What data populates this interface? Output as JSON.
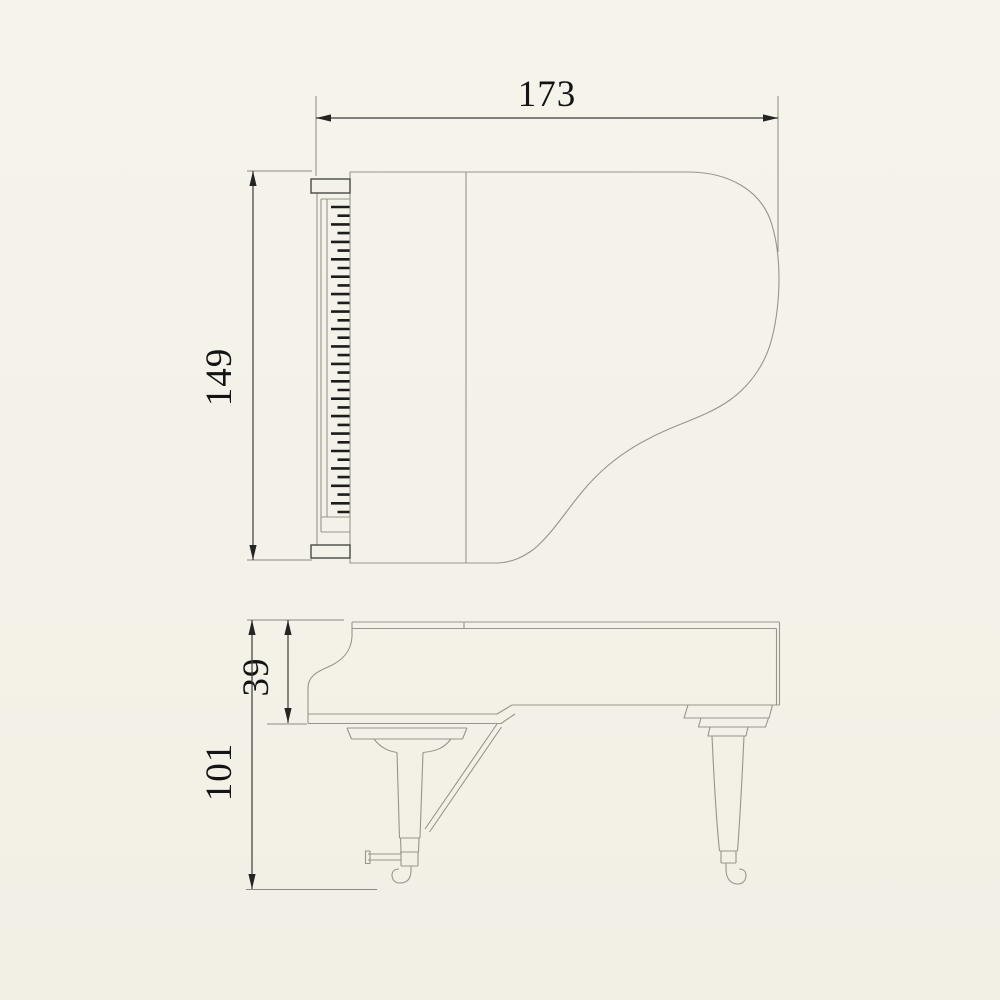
{
  "diagram": {
    "type": "technical-dimension-drawing",
    "subject": "grand piano two-view outline drawing",
    "views": {
      "top_view": {
        "name": "plan view (top)"
      },
      "side_view": {
        "name": "side elevation view"
      }
    },
    "dimensions": {
      "width": {
        "value": "173",
        "location": "top, horizontal, above plan view"
      },
      "depth": {
        "value": "149",
        "location": "left of plan view, rotated 90deg"
      },
      "keyboard_height": {
        "value": "39",
        "location": "left of side view, rotated 90deg"
      },
      "overall_height": {
        "value": "101",
        "location": "left of side view, rotated 90deg"
      }
    },
    "colors": {
      "background": "#f4f2e8",
      "outline_gray": "#97958c",
      "dimension_line": "#3c3c3a",
      "text": "#141414",
      "key_dashes": "#1c1c1c"
    }
  }
}
